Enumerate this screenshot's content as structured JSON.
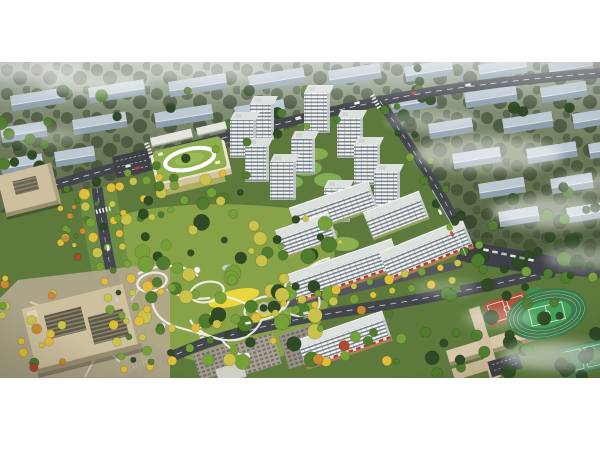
{
  "meta": {
    "type": "aerial-architectural-rendering",
    "view": "bird's-eye view of a residential development masterplan with central park"
  },
  "frame": {
    "render_width": 600,
    "render_height": 316,
    "top_margin": 62,
    "bottom_margin": 72
  },
  "palette": {
    "page_bg": "#ffffff",
    "backdrop_top": "#9aa697",
    "backdrop_mid": "#6d7a58",
    "backdrop_deep": "#505f3e",
    "backdrop_low": "#55663e",
    "bg_slab_roof": "#bdc9d3",
    "bg_slab_face": "#8fa0ad",
    "road": "#43464c",
    "road_line": "#e8e8e4",
    "street_minor": "#54575d",
    "parking": "#3e4147",
    "site_a": "#6d8844",
    "site_b": "#5d7a3c",
    "park_grass": "#8aa449",
    "path_white": "#f4f3ea",
    "lawn_yellow": "#e9d73b",
    "pond": "#b8d6d8",
    "tree_dark": "#2f4a24",
    "tree_green": "#4f7c2d",
    "tree_light": "#76a038",
    "tree_yellow": "#c9c24b",
    "tree_gold": "#e0be3c",
    "tree_orange": "#c98a32",
    "tree_red": "#ae4a2d",
    "tower_face": "#f4f5f2",
    "tower_stripe": "#5c6773",
    "tower_roof": "#dde1dd",
    "tower_shade": "#c2c8cd",
    "retail_base": "#a97f57",
    "retail_awning": "#b43a2a",
    "beige_roof": "#cec09f",
    "beige_face": "#9a8e71",
    "beige_dark": "#5e5944",
    "kroof": "#8fae4e",
    "cream": "#ece4cb",
    "field_ring": "#3d7a4b",
    "field_green": "#44a05c",
    "court_red": "#b04e38",
    "court_green": "#3f8f55",
    "gray_bldg": "#a19b91",
    "boulevard_green": "#6d8f44",
    "fog": "#ffffff"
  },
  "scene": {
    "regions": [
      {
        "name": "background-city",
        "label": "hazy rows of apartment slabs among dark trees"
      },
      {
        "name": "tower-cluster",
        "label": "white high-rise residential point towers"
      },
      {
        "name": "slab-cluster",
        "label": "mid-rise white slab apartments with ground-floor retail"
      },
      {
        "name": "central-park",
        "label": "landscaped park with looping white paths and yellow lawn"
      },
      {
        "name": "kindergarten",
        "label": "green-roofed kindergarten with white oval roof path"
      },
      {
        "name": "office-district",
        "label": "beige office blocks with plazas on the west side"
      },
      {
        "name": "boulevard",
        "label": "tree-lined boulevard with golden street trees"
      },
      {
        "name": "school-campus",
        "label": "school buildings with red courts"
      },
      {
        "name": "sports-field",
        "label": "running track with green infield and sports court"
      },
      {
        "name": "fog-clouds",
        "label": "low white clouds drifting over the scene"
      }
    ]
  }
}
